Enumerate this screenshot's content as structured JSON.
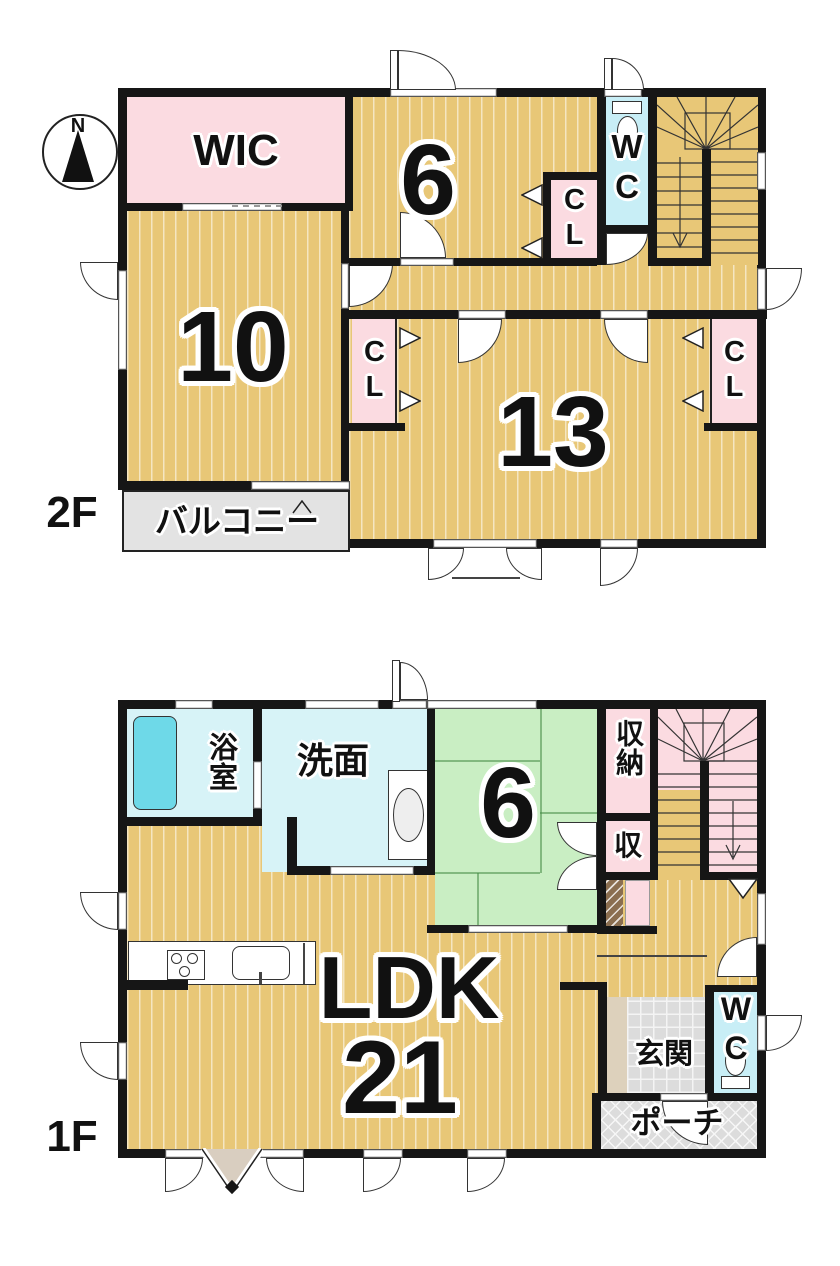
{
  "compass": {
    "north_label": "N"
  },
  "f2": {
    "floor_label": "2F",
    "wic": "WIC",
    "room6": "6",
    "wc": "WC",
    "cl_hall": "CL",
    "room10": "10",
    "room13": "13",
    "cl_left": "CL",
    "cl_right": "CL",
    "balcony": "バルコニー"
  },
  "f1": {
    "floor_label": "1F",
    "bath": "浴室",
    "washroom": "洗面",
    "tatami": "6",
    "storage": "収納",
    "storage_small": "収",
    "ldk": "LDK",
    "ldk_size": "21",
    "entrance": "玄関",
    "wc": "WC",
    "porch": "ポーチ"
  },
  "colors": {
    "wood_floor": "#e8c777",
    "closet_pink": "#fbdbe1",
    "water_cyan": "#c8eef6",
    "bath_floor": "#d7f3f7",
    "bathtub": "#6ed9e8",
    "tatami_green": "#c9eec3",
    "balcony_gray": "#e3e3e3",
    "tile_gray": "#dcdcdc",
    "step_beige": "#ddd1bc",
    "cabinet_brown": "#8b6e50",
    "wall": "#161616"
  }
}
